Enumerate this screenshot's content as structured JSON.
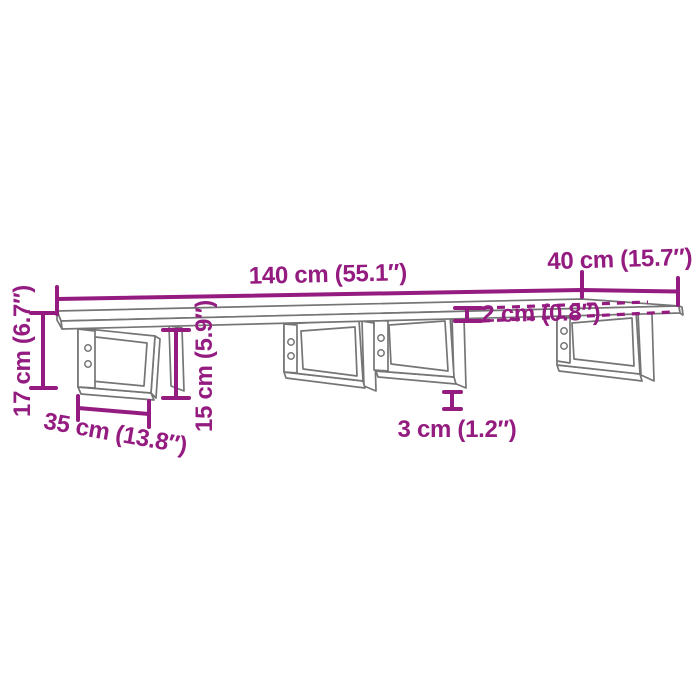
{
  "diagram": {
    "kind": "product dimension diagram",
    "product": "wall-mounted shelf board with four steel brackets",
    "colors": {
      "dimension_annotation": "#941b80",
      "product_outline": "#757575",
      "background": "#ffffff"
    },
    "dimensions": {
      "length": {
        "label": "140 cm (55.1″)",
        "cm": 140,
        "inches": 55.1
      },
      "depth": {
        "label": "40 cm (15.7″)",
        "cm": 40,
        "inches": 15.7
      },
      "board_thickness": {
        "label": "2 cm (0.8″)",
        "cm": 2,
        "inches": 0.8
      },
      "total_height": {
        "label": "17 cm (6.7″)",
        "cm": 17,
        "inches": 6.7
      },
      "bracket_height": {
        "label": "15 cm (5.9″)",
        "cm": 15,
        "inches": 5.9
      },
      "bracket_depth": {
        "label": "35 cm (13.8″)",
        "cm": 35,
        "inches": 13.8
      },
      "bracket_foot": {
        "label": "3 cm (1.2″)",
        "cm": 3,
        "inches": 1.2
      }
    },
    "bracket_count": 4,
    "screws_per_bracket": 2
  }
}
